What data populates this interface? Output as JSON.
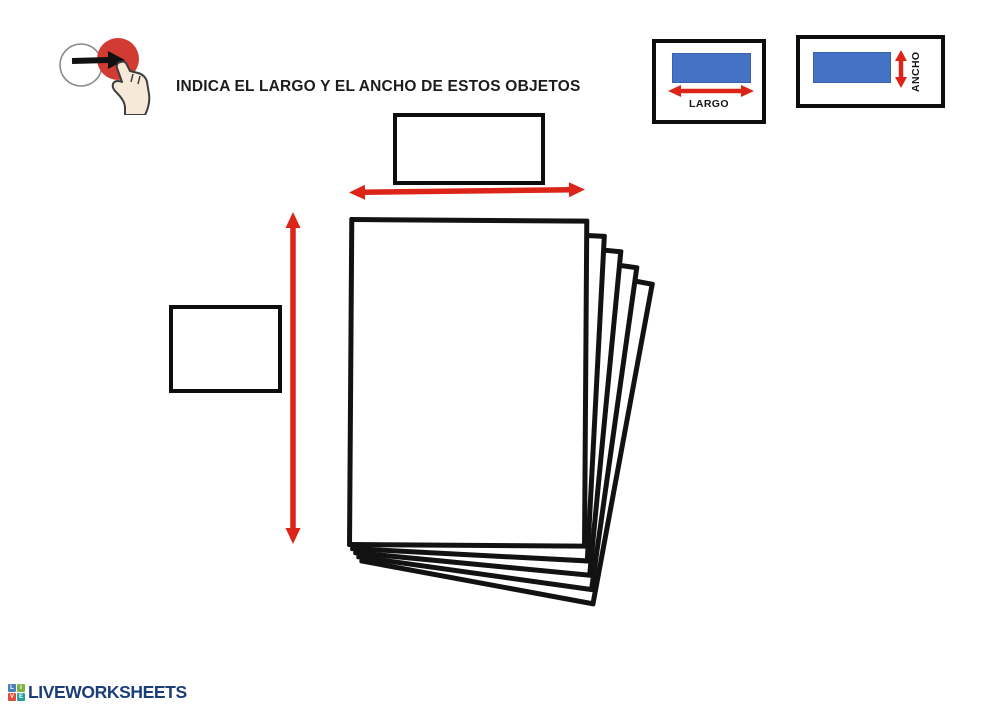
{
  "header": {
    "instruction": "INDICA EL LARGO Y EL ANCHO DE ESTOS OBJETOS",
    "pointer_icon": "point-and-press-icon"
  },
  "legend": {
    "largo": {
      "label": "LARGO"
    },
    "ancho": {
      "label": "ANCHO"
    },
    "swatch_color": "#4472c4",
    "arrow_color": "#dc2418",
    "box_border_color": "#0d0d0d"
  },
  "exercise": {
    "object_name": "stack-of-paper-sheets",
    "sheets_count": 5,
    "answers": {
      "top": {
        "value": ""
      },
      "left": {
        "value": ""
      }
    }
  },
  "footer": {
    "brand": "LIVEWORKSHEETS",
    "brand_color": "#1b3e78",
    "logo_tiles": [
      {
        "letter": "L",
        "color": "#4a7ebb"
      },
      {
        "letter": "I",
        "color": "#7cb342"
      },
      {
        "letter": "V",
        "color": "#e04b3a"
      },
      {
        "letter": "E",
        "color": "#2aa198"
      }
    ]
  }
}
